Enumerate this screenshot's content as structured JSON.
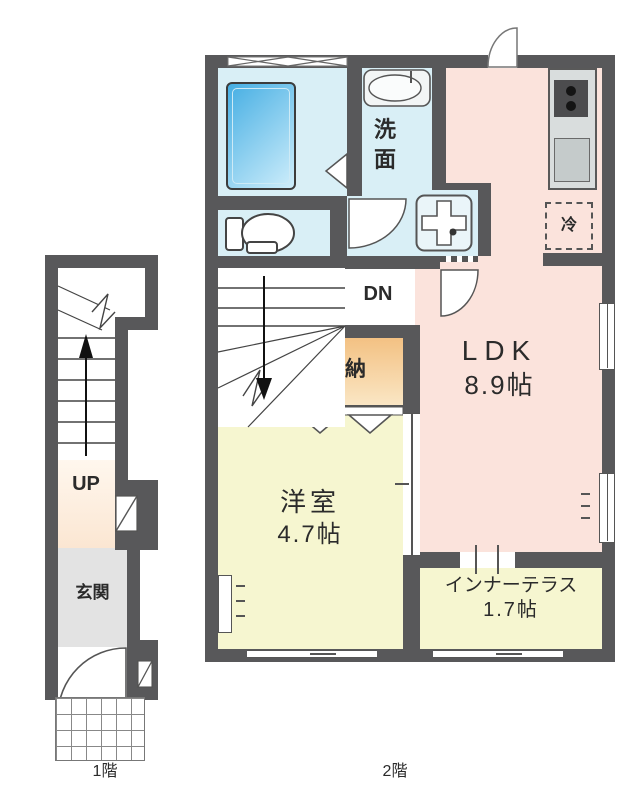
{
  "page": {
    "type": "apartment-floor-plan"
  },
  "floor1": {
    "label": "1階",
    "up_label": "UP",
    "entrance": "玄関"
  },
  "floor2": {
    "label": "2階",
    "ldk_name": "LDK",
    "ldk_size": "8.9帖",
    "washroom": "洗面",
    "dn_label": "DN",
    "storage": "収納",
    "western_name": "洋室",
    "western_size": "4.7帖",
    "terrace_name": "インナーテラス",
    "terrace_size": "1.7帖",
    "fridge": "冷"
  },
  "colors": {
    "wall": "#58585a",
    "wet_area": "#d9eff6",
    "ldk": "#fbe3dc",
    "room_yellow": "#f6f6d0",
    "storage_top": "#f3c183",
    "storage_bottom": "#fae6c4",
    "entrance_floor": "#e3e3e3",
    "hall_cream": "#fdeedd",
    "tub_blue": "#45aee3",
    "counter_gray": "#d9dddd"
  },
  "icons": {
    "bathtub-icon": "rounded rectangle with blue gradient",
    "toilet-icon": "tank and bowl outline",
    "sink-icon": "oval basin with faucet",
    "washer-pan-icon": "rounded square with cross and drain dot",
    "stove-icon": "dark rectangle with two burners",
    "kitchen-sink-icon": "gray rectangle",
    "door-arc-icon": "quarter-circle swing",
    "stairs-icon": "treads with direction arrow",
    "window-icon": "white break in wall",
    "louver-window-icon": "X pattern band"
  }
}
